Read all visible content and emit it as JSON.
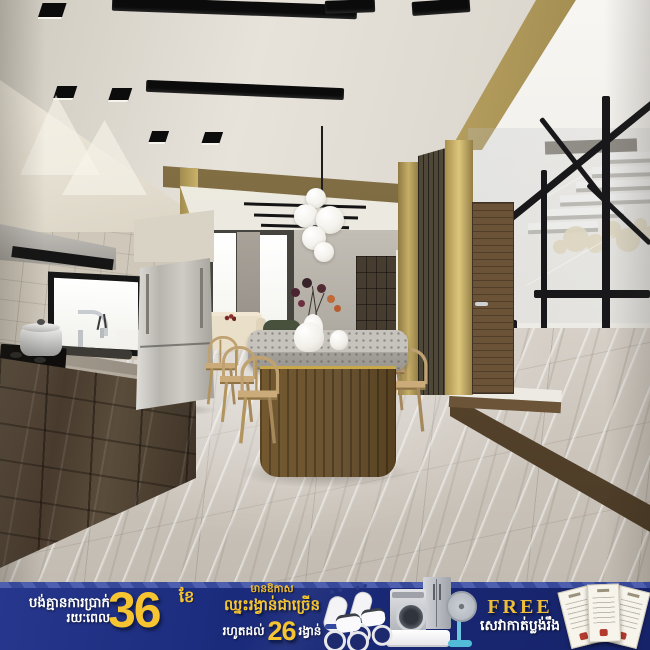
{
  "canvas": {
    "width": 650,
    "height": 650
  },
  "scene": {
    "description": "3D render of a modern townhouse interior: kitchen with dark glossy cabinets, stone-top wooden island with wishbone chairs, gold wall panels, wooden door, staircase with black steel railing and grey marble floor",
    "palette": {
      "ceiling": "#e2ded6",
      "wall_beige": "#e8e2d5",
      "gold_panel": "#bfa55e",
      "cabinet_wood": "#4c3f31",
      "island_wood": "#6d5635",
      "floor_marble": "#cbc4ba",
      "stair_wall": "#f2f0eb",
      "railing_black": "#1a1a18",
      "door_wood": "#6b5338"
    }
  },
  "banner": {
    "bg_color": "#1c2b77",
    "gold_color": "#f5c431",
    "installment": {
      "line1": "បង់គ្មានការប្រាក់",
      "line2": "រយៈពេល",
      "number": "36",
      "unit": "ខែ"
    },
    "prizes": {
      "badge": "មានឱកាស",
      "headline": "ឈ្នះរង្វាន់ជាច្រើន",
      "upto": "រហូតដល់",
      "number": "26",
      "unit": "រង្វាន់"
    },
    "free_offer": {
      "title": "FREE",
      "service": "សេវាកាត់ប្លង់រឹង"
    },
    "prize_icons": [
      "scooter-icon",
      "washing-machine-icon",
      "refrigerator-icon",
      "stand-fan-icon",
      "air-conditioner-icon",
      "land-title-document-icon"
    ]
  }
}
